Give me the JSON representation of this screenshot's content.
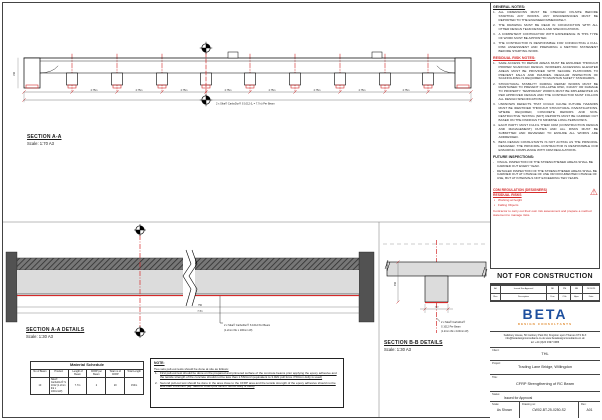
{
  "sections": {
    "a": {
      "label": "SECTION A-A",
      "scale": "Scale: 1:70 A3"
    },
    "a_details": {
      "label": "SECTION A-A DETAILS",
      "scale": "Scale: 1:30 A3",
      "annotation_line1": "2 x Sika® CarboDur® S 1012 Per Beam",
      "annotation_line2": "(1.2mm thk x 100mm W)",
      "dim_top": "750",
      "dim_bottom": "7.7m"
    },
    "b_details": {
      "label": "SECTION B-B DETAILS",
      "scale": "Scale: 1:30 A3",
      "annotation_line1": "2 x Sika® CarboDur®",
      "annotation_line2": "S 1012 Per Beam",
      "annotation_line3": "(1.2mm thk x 100mm W)",
      "depth_dim": "450",
      "width_dim": "100"
    }
  },
  "elevation": {
    "bay_dim": "2.75m",
    "end_dim": "150",
    "overall_label": "2 x Sika® CarboDur® S 1012 (L = 7.7m) Per Beam"
  },
  "material_schedule": {
    "title": "Material Schedule",
    "headers": [
      "No of Beam",
      "Product",
      "Length of Beam",
      "CFRP per Beam",
      "Total no of CFRP",
      "Total Length"
    ],
    "row": [
      "10",
      "Sika® CarboDur® S 1012 (1.2mm thk x 100mmW)",
      "7.7m",
      "2",
      "20",
      "154m"
    ]
  },
  "note_box": {
    "title": "NOTE:",
    "intro": "Two sets pull-out tests should be done at site as follows:",
    "items": [
      "First pull-out test should be done on the prepared and primered surface of the concrete beams prior applying the epoxy adhesive and the tensile strength of the concrete should not be less than 1.5N/mm² (equivalent to 3.0kN pull force if 50mm dolly is used)",
      "Second pull-out test should be done in the area close to the CFRP area and the tensile strength of the epoxy adhesive should not be less than 3.0N/mm² (eq. rated to 6.0kN pull force if 50mm dolly is used)"
    ]
  },
  "general_notes": {
    "title": "GENERAL NOTES:",
    "items": [
      "ALL DIMENSIONS MUST BE CHECKED ON-SITE BEFORE STARTING ANY WORKS. ANY DISCREPANCIES MUST BE REPORTED TO THE ENGINEER IMMEDIATELY.",
      "THE DRAWING MUST BE READ IN CONJUNCTION WITH ALL OTHER DESIGN TEAM DETAILS AND SPECIFICATIONS.",
      "A COMPETENT CONTRACTOR WITH EXPERIENCE IN THIS TYPE OF WORK MUST BE APPOINTED.",
      "THE CONTRACTOR IS RESPONSIBLE FOR CONDUCTING A FULL RISK ASSESSMENT AND PREPARING A METHOD STATEMENT BEFORE STARTING WORK."
    ]
  },
  "residual_risk": {
    "title": "RESIDUAL RISK NOTES:",
    "items": [
      "SAFE ACCESS TO REPAIR AREAS MUST BE ENSURED THROUGH PROPER SCAFFOLD DESIGN. WORKERS ACCESSING ELEVATED AREAS MUST BE PROVIDED WITH SECURE PLATFORMS TO PREVENT FALLS AND INJURIES. REGULAR INSPECTION OF SCAFFOLDING IS REQUIRED TO MAINTAIN SAFETY STANDARDS.",
      "STRUCTURAL STABILITY DURING REPAIR WORKS MUST BE MAINTAINED TO PREVENT COLLAPSE RISK, INJURY OR DAMAGE TO PROPERTY. TEMPORARY WORKS MUST BE IMPLEMENTED AS PER APPROVED DESIGN AND THE CONTRACTOR MUST FOLLOW ALL DESIGN SPECIFICATIONS.",
      "UNKNOWN DEFECTS THAT COULD CAUSE FUTURE HAZARDS MUST BE IDENTIFIED THROUGH STRUCTURAL INVESTIGATIONS. WHERE REQUIRED, CONCRETE REPAIRS AND NON-DESTRUCTIVE TESTING (NDT) REPORTS MUST BE CARRIED OUT BASED ON THE FINDINGS TO MINIMISE LONG-TERM RISKS.",
      "EACH PARTY MUST FULFIL THEIR CDM (CONSTRUCTION DESIGN AND MANAGEMENT) DUTIES AND ALL RISKS MUST BE SUBMITTED AND REVIEWED TO ENSURE ALL WORKS ARE ADDRESSED.",
      "BETA DESIGN CONSULTANTS IS NOT ACTING AS THE PRINCIPAL DESIGNER. THE PRINCIPAL CONTRACTOR IS RESPONSIBLE FOR ENSURING COMPLIANCE WITH CDM REGULATIONS."
    ]
  },
  "future_inspections": {
    "title": "FUTURE INSPECTIONS:",
    "items": [
      "VISUAL INSPECTION OF THE STRENGTHENED AREAS SHALL BE CARRIED OUT EVERY YEAR.",
      "DETAILED INSPECTION OF THE STRENGTHENED AREAS SHALL BE CARRIED OUT AT CHANGE OF USE OR DOCUMENTED CHANGE OF USE, BUT AT INTERVALS NOT EXCEEDING TEN YEARS."
    ]
  },
  "cdm": {
    "title": "CDM REGULATION (DESIGNERS) RESIDUAL RISKS",
    "bullets": [
      "Working at height",
      "Falling Objects"
    ],
    "note": "Contractor to carry out their own risk assessment and prepare a method statement to manage risks.",
    "warning_icon": "⚠"
  },
  "stamp": {
    "text": "NOT FOR CONSTRUCTION"
  },
  "revision_table": {
    "entry": [
      "A0",
      "Issued For Approval",
      "NK",
      "PM",
      "RB",
      "24/10/25"
    ],
    "header": [
      "Rev",
      "Description",
      "Drw",
      "Chk",
      "Aprv",
      "Date"
    ]
  },
  "company": {
    "name": "BETA",
    "tagline": "DESIGN CONSULTANTS",
    "address": "Salisbury House, 50 Canbury Park Rd, Kingston upon Thames KT2 6LX",
    "contacts": "info@betadesignconsultants.co.uk    www.betadesignconsultants.co.uk",
    "tel": "tel: +44 (0)20 3397 0986"
  },
  "title_block": {
    "client_label": "Client:",
    "client": "THL",
    "project_label": "Project:",
    "project": "Trading Lane Bridge, Willingdon",
    "title_label": "Title:",
    "title": "CFRP Strengthening of RC Beam",
    "status_label": "Status:",
    "status": "Issued for Approval",
    "scale_label": "Scale:",
    "scale": "As Shown",
    "drawing_no_label": "Drawing no:",
    "drawing_no": "CW02-BT-25-0250-S2",
    "rev_label": "Rev:",
    "rev": "A01"
  }
}
